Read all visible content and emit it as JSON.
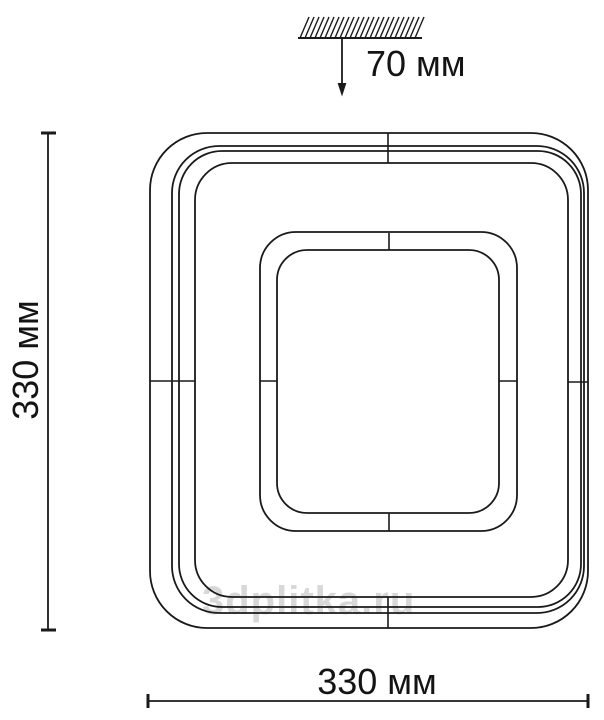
{
  "colors": {
    "background": "#ffffff",
    "line": "#1a1a1a",
    "text": "#141414",
    "watermark": "#d8d8d8"
  },
  "diagram": {
    "mount_offset_label": "70 мм",
    "height_label": "330 мм",
    "width_label": "330 мм",
    "watermark_text": "3dplitka.ru",
    "values": {
      "mount_offset_mm": 70,
      "height_mm": 330,
      "width_mm": 330
    }
  }
}
